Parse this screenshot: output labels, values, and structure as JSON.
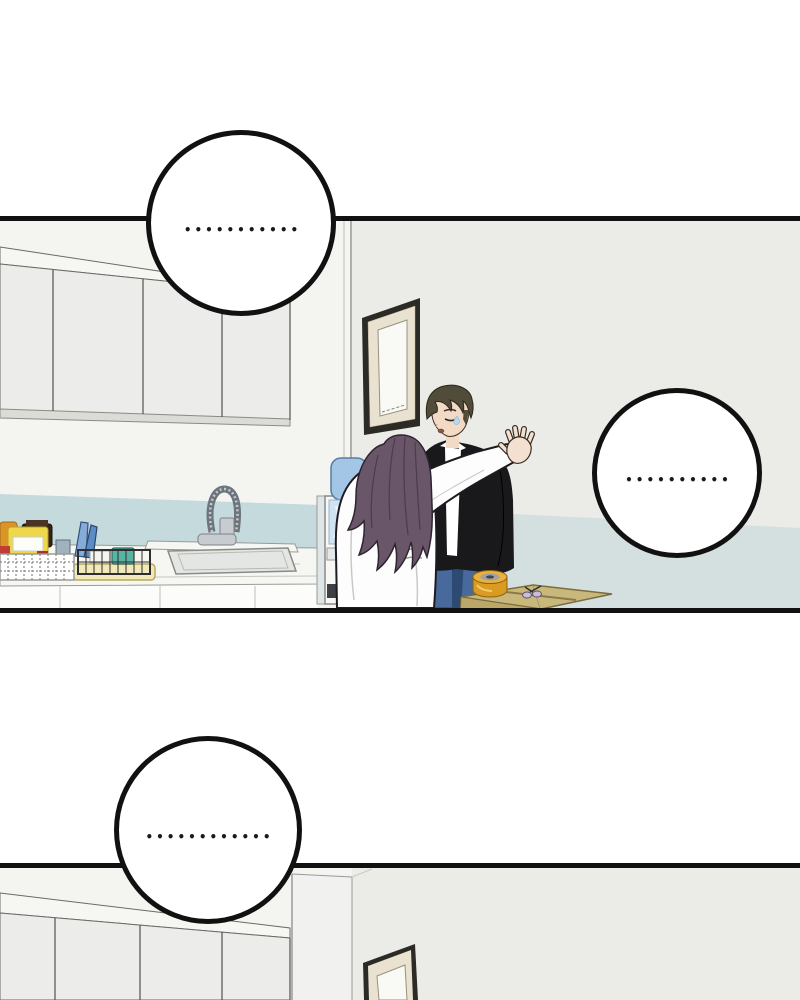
{
  "bubbles": [
    {
      "dots": "•••••••••••"
    },
    {
      "dots": "••••••••••"
    },
    {
      "dots": "••••••••••••"
    }
  ],
  "colors": {
    "page_bg": "#ffffff",
    "line": "#111111",
    "bubble_fill": "#ffffff",
    "dots": "#1a1a1a",
    "wall_left": "#f4f4f1",
    "wall_right": "#ebece8",
    "wainscot": "#c5dadd",
    "floor": "#d3e0df",
    "cabinet": "#ececea",
    "cabinet_top": "#f6f6f3",
    "valance": "#dcdcd7",
    "marble": "#f6f6f3",
    "lower_cabinet": "#fcfcfa",
    "sink": "#e4e6e3",
    "steel": "#c7ccd1",
    "tray": "#f2e9ba",
    "board_light": "#85abd9",
    "board_dark": "#5a8cc6",
    "mug": "#5ab4a4",
    "amber_jar": "#dd9427",
    "yellow_jar": "#eed84a",
    "dark_jar": "#33221a",
    "red_jar": "#bf3d35",
    "cooler_body": "#f7f8f6",
    "cooler_side": "#dfe6e8",
    "bottle": "#a3c6e6",
    "bottle_light": "#cfe3f3",
    "slot": "#3c4044",
    "hair_woman": "#695669",
    "robe": "#fdfdfd",
    "outline_dark": "#1f1a20",
    "skin": "#f2dac6",
    "hair_man": "#514c3a",
    "jacket": "#19181b",
    "shirt": "#ffffff",
    "jeans": "#47699b",
    "jeans_dark": "#2d4a72",
    "frame": "#2b2a25",
    "frame_mat": "#e9e2d1",
    "frame_inner": "#f9f9f6",
    "box_top": "#c9b87c",
    "box_side": "#bba768",
    "box_line": "#8a7a4a",
    "tape_side": "#d99b22",
    "tape_top": "#ecb03c",
    "tape_inner": "#9fa3a3",
    "tape_core": "#43474b",
    "sweat": "#b8d6ec",
    "scissors": "#cabdd6"
  }
}
